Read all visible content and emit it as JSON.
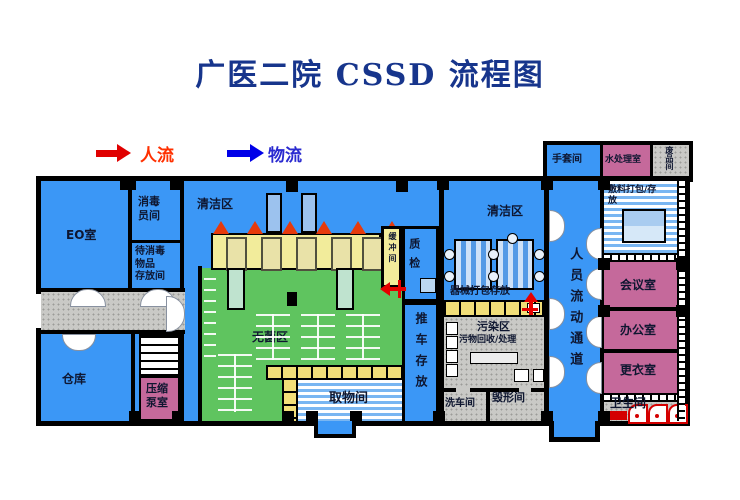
{
  "title": "广医二院 CSSD 流程图",
  "legend": {
    "people_flow_label": "人流",
    "material_flow_label": "物流"
  },
  "colors": {
    "title_navy": "#17358C",
    "people_flow_red": "#FF3000",
    "material_flow_blue": "#2A2AD0",
    "room_blue": "#3B97F6",
    "sterile_green": "#5FC45F",
    "band_yellow": "#F2EC9B",
    "cell_yellow": "#F2DE78",
    "room_pink": "#C5699B",
    "corridor_gray": "#C9C9C6",
    "wall_black": "#000000"
  },
  "rooms": {
    "eo_room": "EO室",
    "disinfection_staff_room_lines": [
      "消毒",
      "员间"
    ],
    "awaiting_disinfection_storage_lines": [
      "待消毒",
      "物品",
      "存放间"
    ],
    "warehouse": "仓库",
    "compression_pump_room_lines": [
      "压缩",
      "泵室"
    ],
    "clean_zone_left": "清洁区",
    "buffer_room": "缓冲间",
    "quality_check": "质检",
    "sterile_zone": "无菌区",
    "pickup_room": "取物间",
    "cart_storage": "推车存放",
    "clean_zone_right": "清洁区",
    "instrument_packing_storage": "器械打包存放",
    "contaminated_zone": "污染区",
    "waste_recycling_processing": "污物回收/处理",
    "cart_wash_room": "洗车间",
    "destruction_room": "毁形间",
    "personnel_flow_corridor": "人员流动通道",
    "glove_room": "手套间",
    "water_treatment_room": "水处理室",
    "scrap_room": "废品间",
    "dressing_packing_storage_lines": [
      "敷料打包/存",
      "放"
    ],
    "meeting_room": "会议室",
    "office": "办公室",
    "changing_room": "更衣室",
    "toilet": "卫生间"
  }
}
